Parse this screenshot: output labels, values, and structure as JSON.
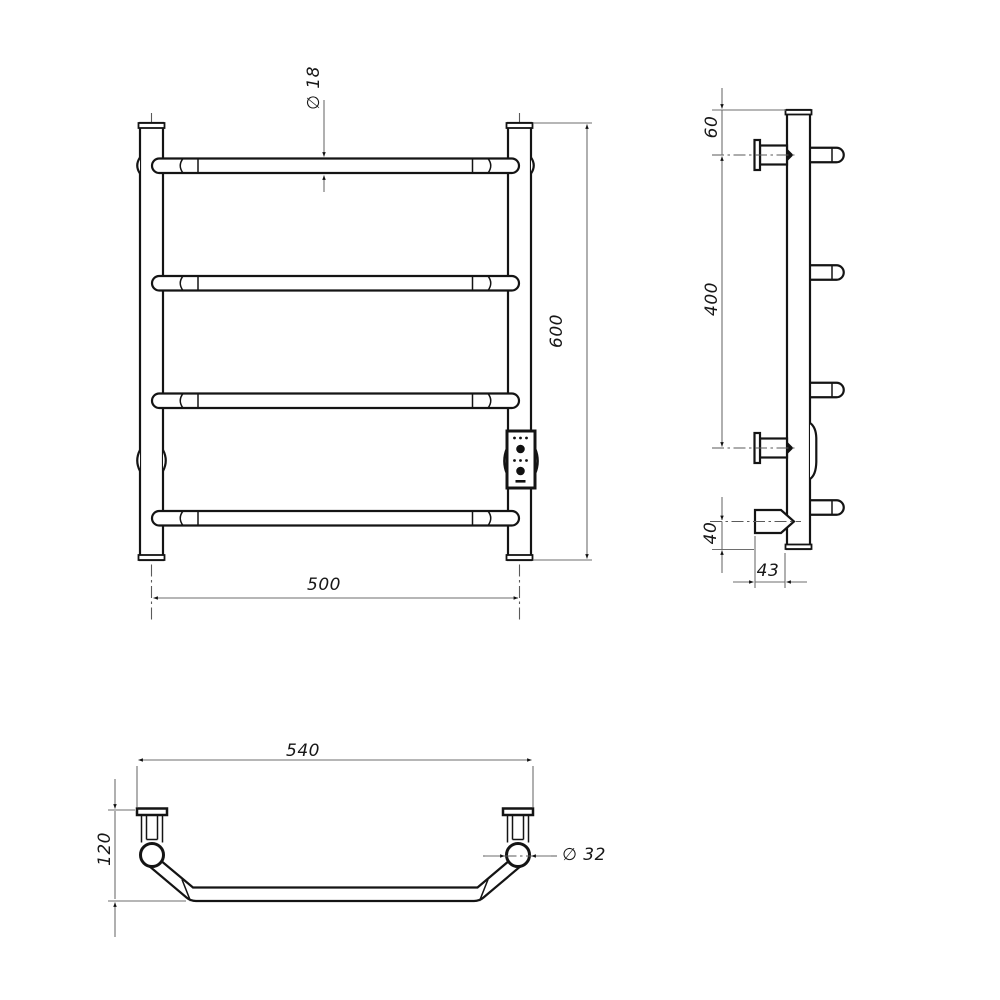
{
  "drawing": {
    "front_view": {
      "bar_diameter": "∅ 18",
      "overall_height": "600",
      "rail_width": "500"
    },
    "side_view": {
      "top_to_bracket": "60",
      "bracket_spacing": "400",
      "heater_offset": "40",
      "wall_depth": "43"
    },
    "bottom_view": {
      "overall_width": "540",
      "depth": "120",
      "post_diameter": "∅ 32"
    }
  }
}
